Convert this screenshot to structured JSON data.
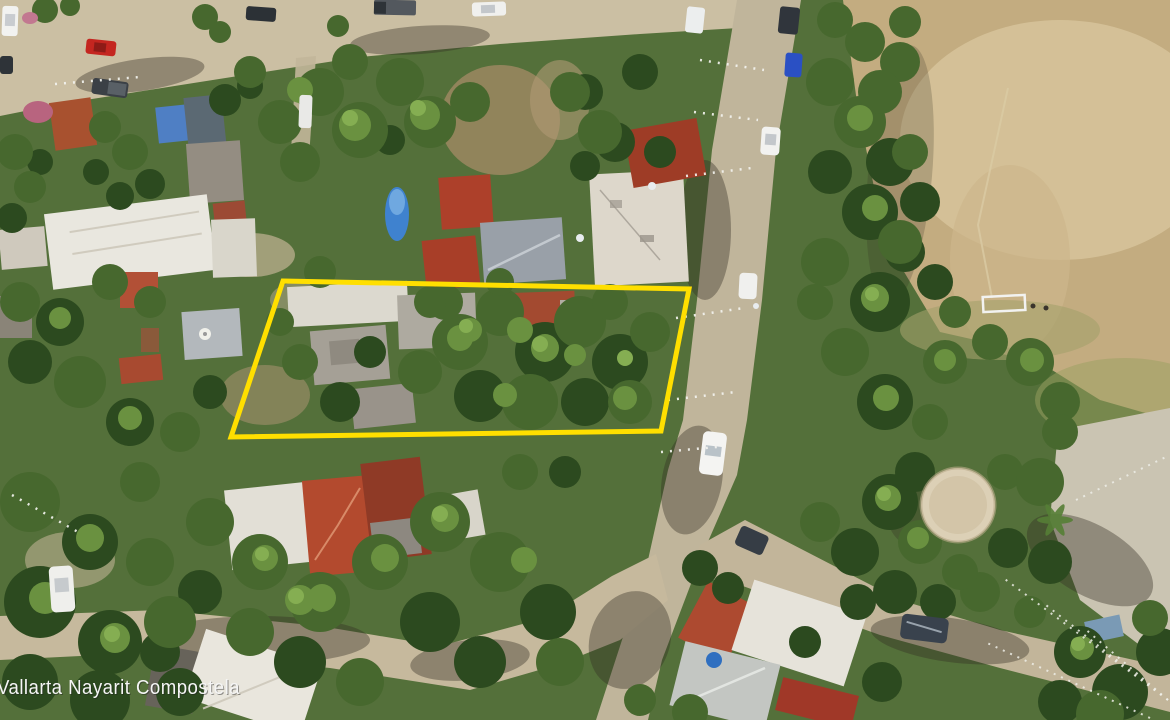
{
  "image": {
    "kind": "aerial-drone-photo",
    "subject": "residential lot for sale outlined in yellow"
  },
  "watermark": {
    "text": "Vallarta Nayarit Compostela"
  },
  "boundary": {
    "points": "283,281 689,289 661,431 231,437"
  },
  "colors": {
    "boundary-color": "#ffdf00",
    "watermark-color": "#f5f5f5"
  },
  "palette": {
    "vegetation": "#4d6a33",
    "dirt_road": "#c9bca0",
    "soccer_field": "#c3ac80",
    "concrete_plaza": "#cac4b2",
    "red_tile_roof": "#ad4a30",
    "white_roof": "#e9e7df",
    "pool_blue": "#3f82cf"
  },
  "scene": {
    "features": [
      "dirt-roads",
      "houses",
      "trees",
      "soccer-field",
      "goal",
      "pavilion",
      "parked-cars",
      "banner-strings"
    ]
  }
}
